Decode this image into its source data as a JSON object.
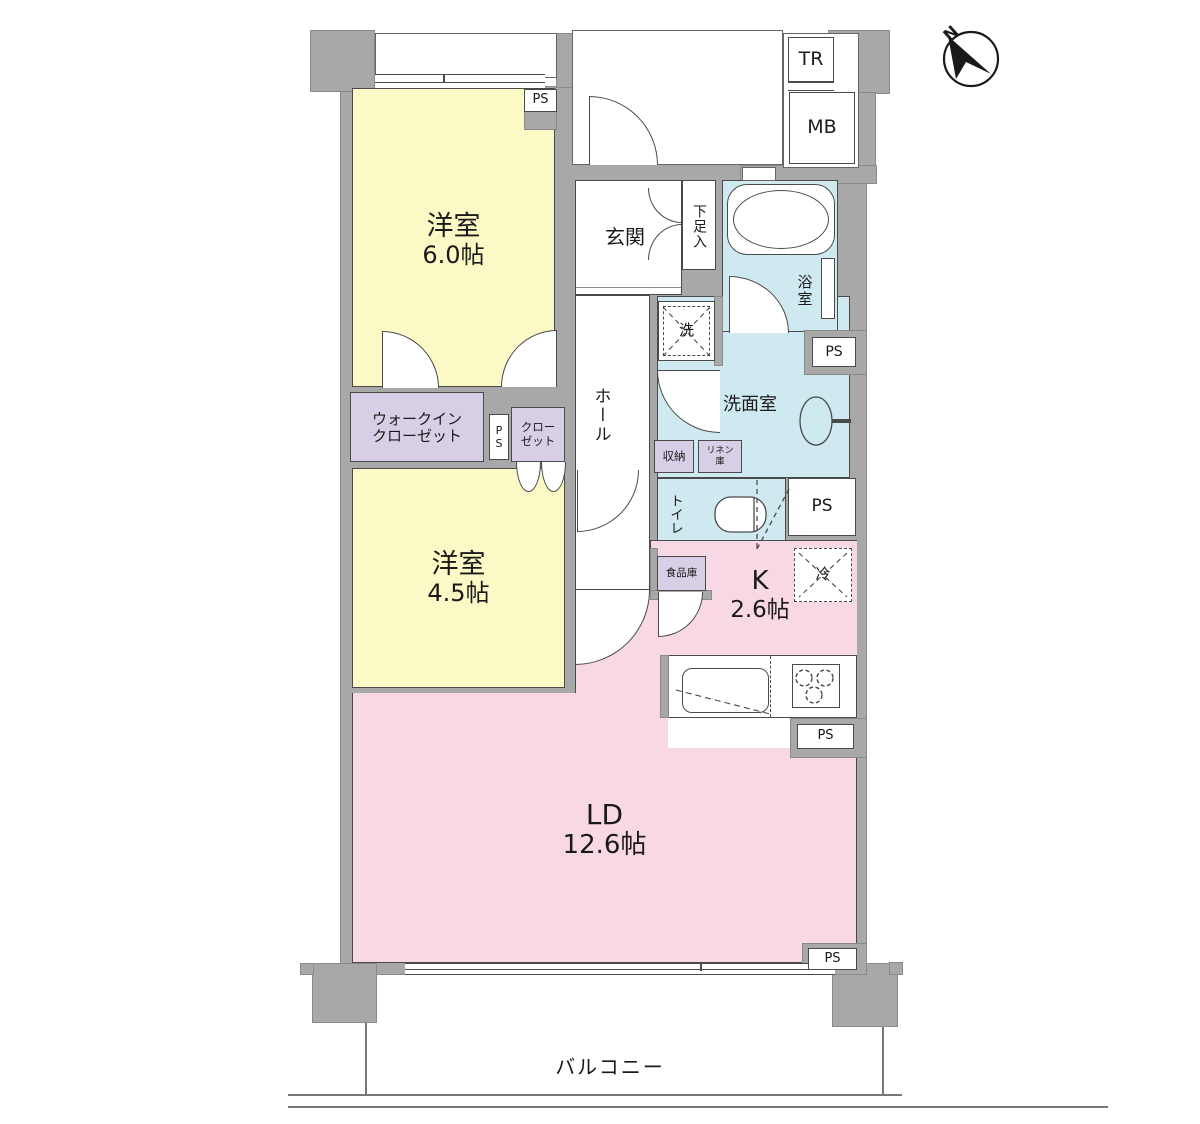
{
  "labels": {
    "ps": "PS",
    "tr": "TR",
    "mb": "MB",
    "north": "N",
    "bedroom1_name": "洋室",
    "bedroom1_size": "6.0帖",
    "bedroom2_name": "洋室",
    "bedroom2_size": "4.5帖",
    "ld_name": "LD",
    "ld_size": "12.6帖",
    "kitchen_name": "K",
    "kitchen_size": "2.6帖",
    "genkan": "玄関",
    "hall": "ホール",
    "shoe_cabinet": "下足入",
    "bath": "浴室",
    "washroom": "洗面室",
    "washer": "洗",
    "toilet": "トイレ",
    "storage": "収納",
    "linen_line1": "リネン",
    "linen_line2": "庫",
    "pantry": "食品庫",
    "fridge": "冷",
    "wic_line1": "ウォークイン",
    "wic_line2": "クローゼット",
    "closet_line1": "クロー",
    "closet_line2": "ゼット",
    "balcony": "バルコニー"
  },
  "colors": {
    "wall": "#a8a8a8",
    "yellow": "#fbf9c5",
    "pink": "#f9d8e5",
    "blue": "#cfe9f1",
    "lavender": "#d8cfe7",
    "line": "#4a4a4a"
  }
}
